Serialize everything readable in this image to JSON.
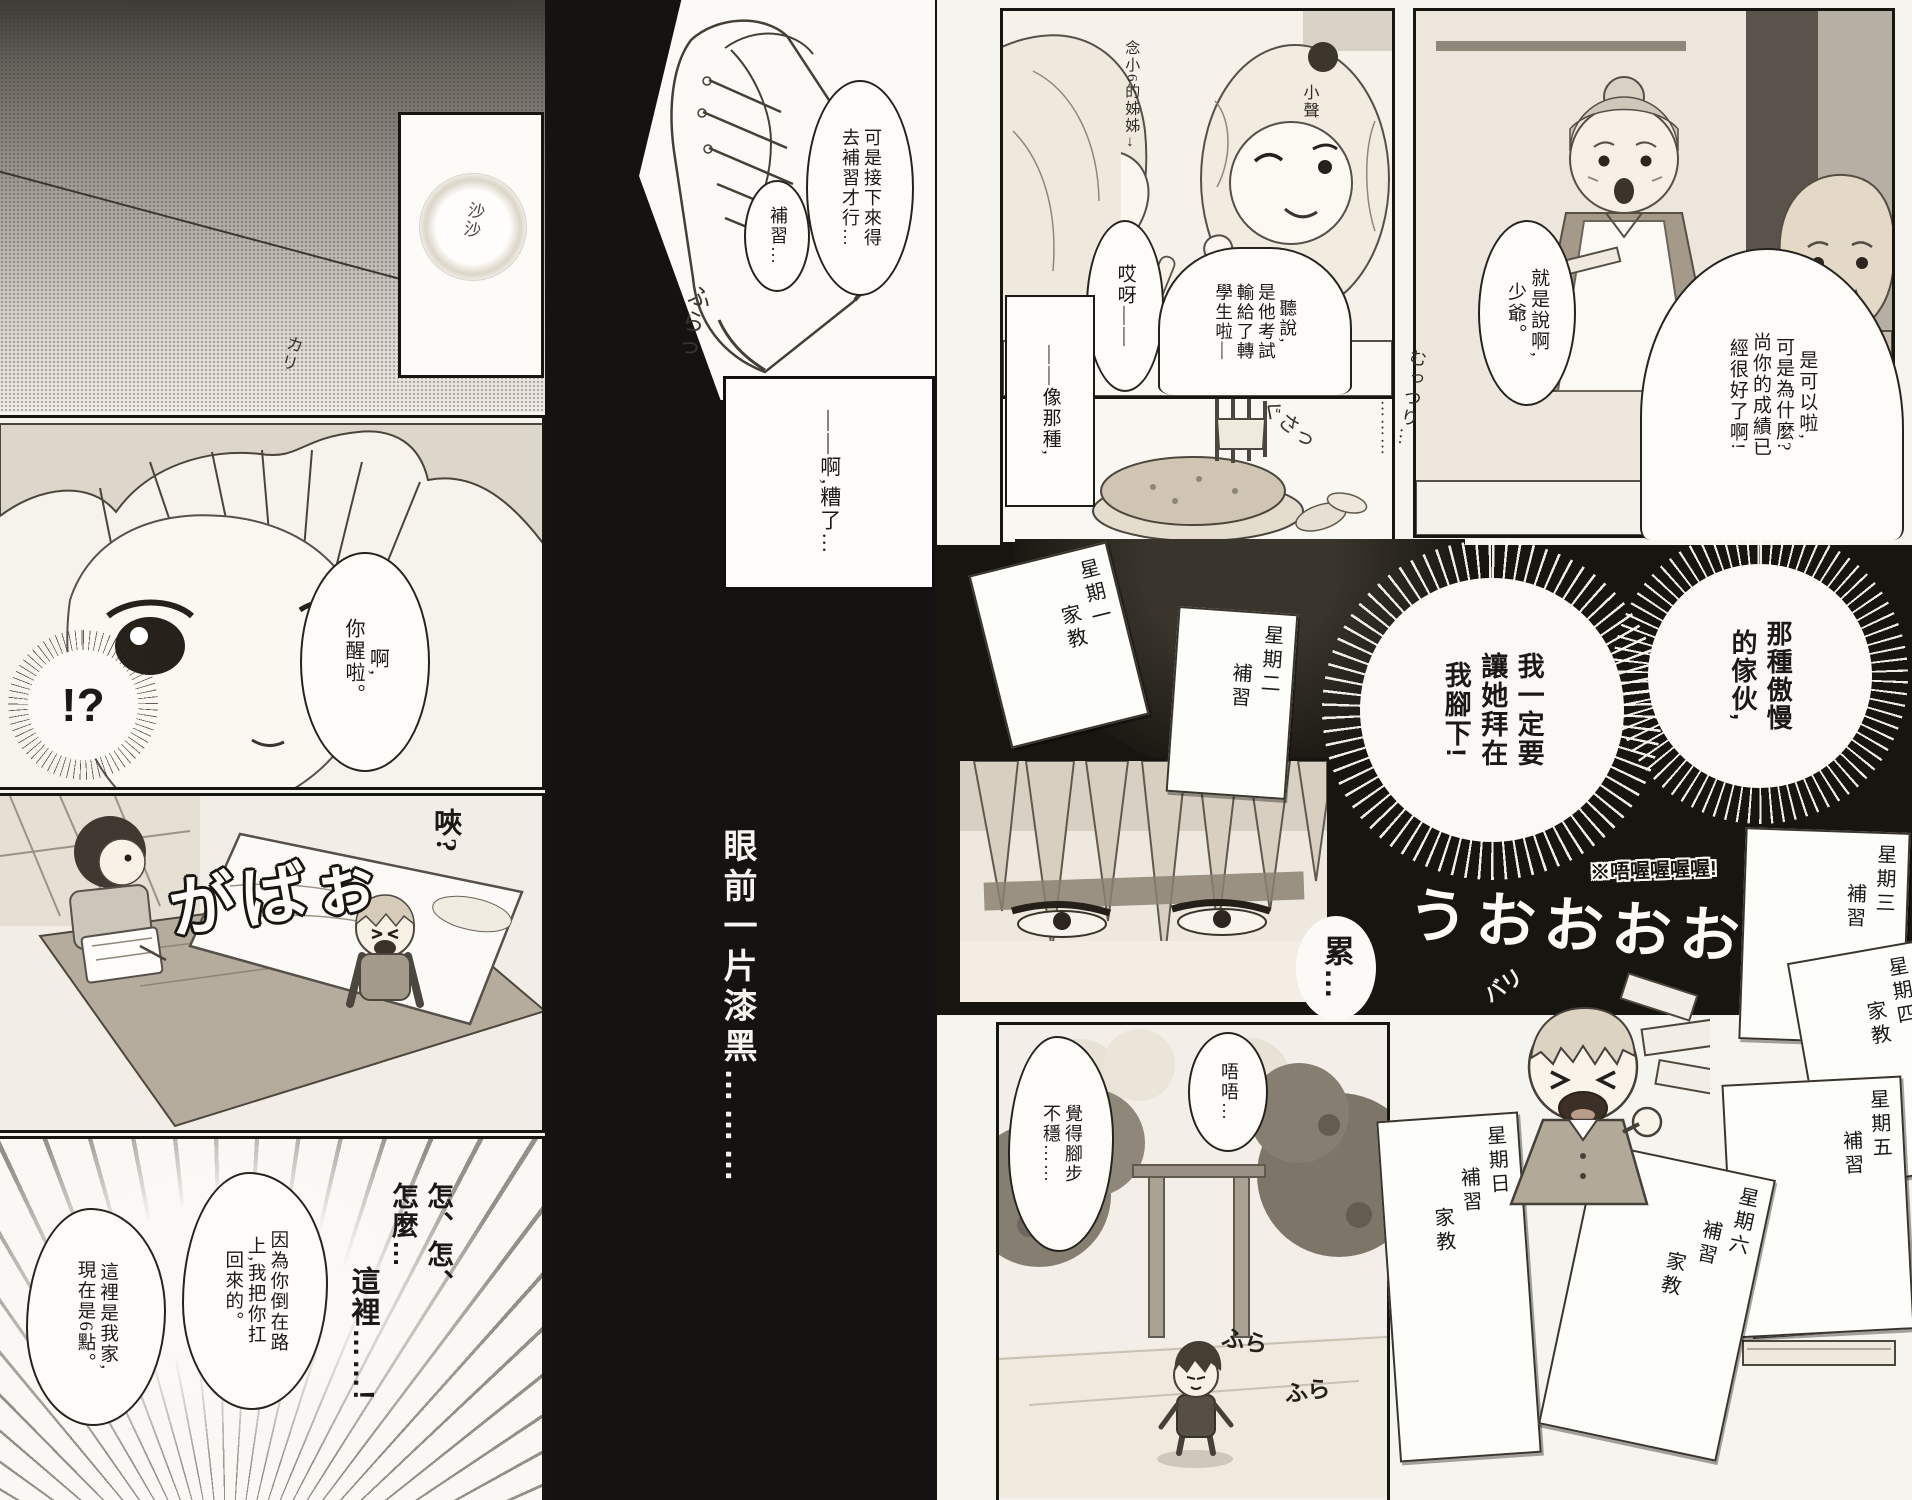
{
  "left_page": {
    "panel_top": {
      "narration_ah": "——啊啊…",
      "narration_sound": "這聲音…",
      "sfx_rustle": "沙沙",
      "sfx_scratch": "カリ"
    },
    "panel_face": {
      "narration_pencil": "是鉛筆的聲音——…",
      "bubble_awake": "啊,\n你醒啦。",
      "exclaim": "!?"
    },
    "panel_bed": {
      "bubble_huh": "唊?",
      "sfx_jump_up": "がばぉ"
    },
    "panel_floor": {
      "stutter": "怎、怎、\n怎麼…",
      "where": "這裡……!",
      "bubble_reason": "因為你倒在路\n上,我把你扛\n回來的。",
      "bubble_home": "這裡是我家,\n現在是6點。"
    }
  },
  "center_column": {
    "bubble_cram_long": "可是接下來得\n去補習才行…",
    "bubble_cram_short": "補習…",
    "sfx_sway": "ふらっ",
    "box_oops": "——啊,糟了…",
    "caption_dark": "眼前一片漆黑………"
  },
  "right_page": {
    "panel_dinner": {
      "label_sister": "念小6的姊姊→",
      "label_whisper": "小聲",
      "bubble_oops": "哎呀——",
      "bubble_rumor": "聽說,\n是他考試\n輸給了轉\n學生啦—",
      "box_like_that": "——像那種,",
      "sfx_stab": "ぐさっ"
    },
    "panel_family": {
      "bubble_butler": "就是說啊,\n少爺。",
      "sfx_sulk": "むっつり…",
      "dots": "………",
      "bubble_mother": "是可以啦,\n可是為什麼?\n尚你的成績已\n經很好了啊!"
    },
    "bursts": {
      "arrogant": "那種傲慢\n的傢伙,",
      "vow": "我一定要\n讓她拜在\n我腳下!"
    },
    "panel_eyes": {
      "sfx_tired": "累…"
    },
    "sfx_note": "※唔喔喔喔喔!",
    "sfx_roar": "うおおおお",
    "sfx_rip": "バリ",
    "panel_street": {
      "bubble_uu": "唔唔…",
      "bubble_unsteady": "覺得腳步\n不穩……",
      "sfx_sway1": "ふら",
      "sfx_sway2": "ふら"
    },
    "schedule_papers": [
      {
        "day": "星期一",
        "items": [
          "家教"
        ]
      },
      {
        "day": "星期二",
        "items": [
          "補習"
        ]
      },
      {
        "day": "星期三",
        "items": [
          "補習"
        ]
      },
      {
        "day": "星期四",
        "items": [
          "家教"
        ]
      },
      {
        "day": "星期五",
        "items": [
          "補習"
        ]
      },
      {
        "day": "星期六",
        "items": [
          "補習",
          "家教"
        ]
      },
      {
        "day": "星期日",
        "items": [
          "補習",
          "家教"
        ]
      }
    ]
  }
}
